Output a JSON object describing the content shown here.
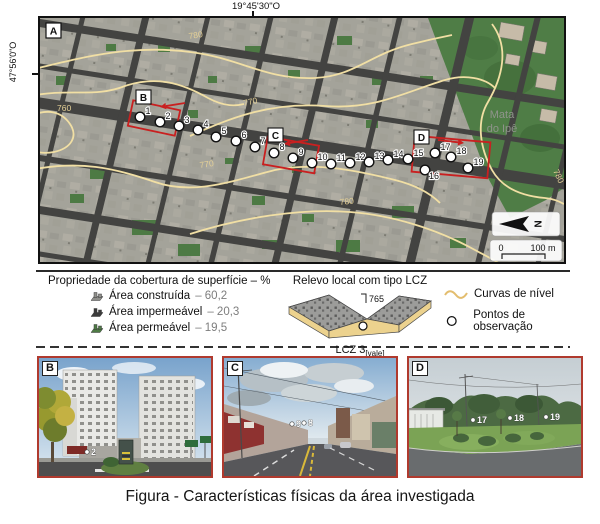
{
  "figure": {
    "caption": "Figura - Características físicas da área investigada"
  },
  "map": {
    "panel_label": "A",
    "coord_top": "19°45'30\"O",
    "coord_left": "47°56'0\"O",
    "forest_line1": "Mata",
    "forest_line2": "do Ipê",
    "north_label": "N",
    "scale_start": "0",
    "scale_end": "100 m",
    "contour_labels": [
      {
        "text": "780",
        "x": 149,
        "y": 21,
        "rot": -8
      },
      {
        "text": "770",
        "x": 204,
        "y": 88,
        "rot": -12
      },
      {
        "text": "760",
        "x": 17,
        "y": 93,
        "rot": 0
      },
      {
        "text": "770",
        "x": 160,
        "y": 150,
        "rot": -8
      },
      {
        "text": "780",
        "x": 300,
        "y": 187,
        "rot": -6
      },
      {
        "text": "780",
        "x": 513,
        "y": 153,
        "rot": 65
      }
    ],
    "points": [
      {
        "n": "1",
        "x": 100,
        "y": 99
      },
      {
        "n": "2",
        "x": 120,
        "y": 104
      },
      {
        "n": "3",
        "x": 139,
        "y": 108
      },
      {
        "n": "4",
        "x": 158,
        "y": 112
      },
      {
        "n": "5",
        "x": 176,
        "y": 119
      },
      {
        "n": "6",
        "x": 196,
        "y": 123
      },
      {
        "n": "7",
        "x": 215,
        "y": 129
      },
      {
        "n": "8",
        "x": 234,
        "y": 135
      },
      {
        "n": "9",
        "x": 253,
        "y": 140
      },
      {
        "n": "10",
        "x": 272,
        "y": 145
      },
      {
        "n": "11",
        "x": 291,
        "y": 146
      },
      {
        "n": "12",
        "x": 310,
        "y": 145
      },
      {
        "n": "13",
        "x": 329,
        "y": 144
      },
      {
        "n": "14",
        "x": 348,
        "y": 142
      },
      {
        "n": "15",
        "x": 368,
        "y": 141
      },
      {
        "n": "16",
        "x": 385,
        "y": 152,
        "dx": 4,
        "dy": 9
      },
      {
        "n": "17",
        "x": 395,
        "y": 135
      },
      {
        "n": "18",
        "x": 411,
        "y": 139
      },
      {
        "n": "19",
        "x": 428,
        "y": 150
      }
    ],
    "inset_boxes": [
      {
        "label": "B",
        "cx": 114,
        "cy": 100,
        "w": 48,
        "h": 26,
        "rot": 12,
        "lx": 96,
        "ly": 72,
        "ax1": 145,
        "ay1": 85,
        "ax2": 120,
        "ay2": 89
      },
      {
        "label": "C",
        "cx": 251,
        "cy": 137,
        "w": 52,
        "h": 28,
        "rot": 10,
        "lx": 228,
        "ly": 110,
        "ax1": 268,
        "ay1": 122,
        "ax2": 244,
        "ay2": 126
      },
      {
        "label": "D",
        "cx": 411,
        "cy": 139,
        "w": 76,
        "h": 36,
        "rot": 5,
        "lx": 374,
        "ly": 112,
        "ax1": 398,
        "ay1": 122,
        "ax2": 424,
        "ay2": 125
      }
    ]
  },
  "legend": {
    "surface": {
      "title": "Propriedade da cobertura de superfície – %",
      "items": [
        {
          "label": "Área construída",
          "value": "– 60,2",
          "color": "#8f8f8b"
        },
        {
          "label": "Área impermeável",
          "value": "– 20,3",
          "color": "#3b3b3b"
        },
        {
          "label": "Área permeável",
          "value": "– 19,5",
          "color": "#4e7b45"
        }
      ]
    },
    "relief": {
      "title": "Relevo local com tipo LCZ",
      "elevation": "765",
      "lcz": "LCZ 3",
      "lcz_sub": "[vale]"
    },
    "symbols": [
      {
        "label": "Curvas de nível"
      },
      {
        "label": "Pontos de observação"
      }
    ]
  },
  "photos": [
    {
      "label": "B",
      "points": [
        {
          "n": "2",
          "x": 52,
          "y": 92
        }
      ]
    },
    {
      "label": "C",
      "points": [
        {
          "n": "9",
          "x": 72,
          "y": 64
        },
        {
          "n": "8",
          "x": 84,
          "y": 63
        }
      ]
    },
    {
      "label": "D",
      "points": [
        {
          "n": "17",
          "x": 68,
          "y": 60
        },
        {
          "n": "18",
          "x": 105,
          "y": 58
        },
        {
          "n": "19",
          "x": 141,
          "y": 57
        }
      ]
    }
  ]
}
